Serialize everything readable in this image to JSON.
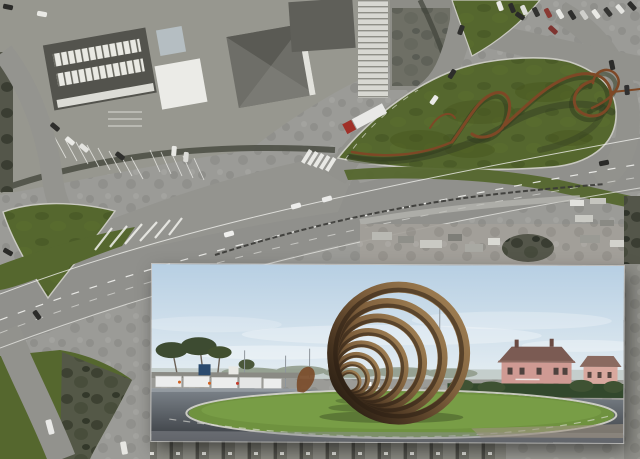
{
  "meta": {
    "width": 640,
    "height": 459,
    "kind": "aerial-photomontage-with-render-inset"
  },
  "palette": {
    "base_gray": "#9b9b97",
    "road_gray": "#90908c",
    "plaza_gray": "#94948f",
    "building_dark": "#53534d",
    "building_white": "#ebebe7",
    "grass_overlay": "#55672e",
    "grass_dark": "#46551f",
    "ribbon_rust": "#7e4826",
    "ribbon_shadow": "#2f3a1e",
    "guardrail": "#3a3a36",
    "marking_white": "#f2f2ee",
    "scrub_dark": "#45473d",
    "hedge_dark": "#4e5046",
    "inset_sky_top": "#b7cfe3",
    "inset_sky_bottom": "#e4edf2",
    "inset_lawn": "#6f923f",
    "inset_asphalt_near": "#383c41",
    "inset_asphalt_far": "#7d848b",
    "ring_light": "#a08054",
    "ring_dark": "#241a10",
    "villa_pink": "#cf9a93",
    "villa_roof": "#7b5b53",
    "pine_green": "#3d4b31",
    "hedge_green": "#32482c",
    "curb_light": "#d6d6cc"
  },
  "aerial": {
    "vehicles": [
      {
        "x": 8,
        "y": 7,
        "r": 12,
        "c": "#2b2b29"
      },
      {
        "x": 42,
        "y": 14,
        "r": 10,
        "c": "#e9e9e5"
      },
      {
        "x": 55,
        "y": 127,
        "r": 40,
        "c": "#2e2e2c"
      },
      {
        "x": 70,
        "y": 141,
        "r": 40,
        "c": "#eaeae6"
      },
      {
        "x": 84,
        "y": 148,
        "r": 40,
        "c": "#e3e3df"
      },
      {
        "x": 120,
        "y": 156,
        "r": 38,
        "c": "#2f2f2d"
      },
      {
        "x": 174,
        "y": 151,
        "r": 95,
        "c": "#e8e8e4"
      },
      {
        "x": 186,
        "y": 157,
        "r": 95,
        "c": "#dcdcd8"
      },
      {
        "x": 500,
        "y": 6,
        "r": 70,
        "c": "#eaeae6"
      },
      {
        "x": 512,
        "y": 8,
        "r": 68,
        "c": "#2c2c2a"
      },
      {
        "x": 524,
        "y": 10,
        "r": 66,
        "c": "#ddddd9"
      },
      {
        "x": 536,
        "y": 12,
        "r": 64,
        "c": "#323230"
      },
      {
        "x": 548,
        "y": 13,
        "r": 62,
        "c": "#8a3a34"
      },
      {
        "x": 560,
        "y": 14,
        "r": 60,
        "c": "#e7e7e3"
      },
      {
        "x": 572,
        "y": 15,
        "r": 58,
        "c": "#2e2e2c"
      },
      {
        "x": 584,
        "y": 15,
        "r": 56,
        "c": "#cfcfcb"
      },
      {
        "x": 596,
        "y": 14,
        "r": 54,
        "c": "#e9e9e5"
      },
      {
        "x": 608,
        "y": 12,
        "r": 52,
        "c": "#343432"
      },
      {
        "x": 620,
        "y": 9,
        "r": 50,
        "c": "#e5e5e1"
      },
      {
        "x": 632,
        "y": 6,
        "r": 48,
        "c": "#2d2d2b"
      },
      {
        "x": 520,
        "y": 16,
        "r": 35,
        "c": "#2a2a28"
      },
      {
        "x": 553,
        "y": 30,
        "r": 42,
        "c": "#7e3430"
      },
      {
        "x": 612,
        "y": 65,
        "r": 78,
        "c": "#2c2c2a"
      },
      {
        "x": 627,
        "y": 90,
        "r": 85,
        "c": "#303030"
      },
      {
        "x": 604,
        "y": 163,
        "r": -12,
        "c": "#2a2a28"
      },
      {
        "x": 434,
        "y": 100,
        "r": -55,
        "c": "#eaeae8"
      },
      {
        "x": 452,
        "y": 74,
        "r": -58,
        "c": "#2d2d2b"
      },
      {
        "x": 461,
        "y": 30,
        "r": -70,
        "c": "#2f2f2d"
      },
      {
        "x": 296,
        "y": 206,
        "r": -15,
        "c": "#ededeb"
      },
      {
        "x": 327,
        "y": 199,
        "r": -15,
        "c": "#eaeae8"
      },
      {
        "x": 229,
        "y": 234,
        "r": -15,
        "c": "#efefed"
      },
      {
        "x": 37,
        "y": 315,
        "r": 55,
        "c": "#2c2c2a"
      },
      {
        "x": 8,
        "y": 252,
        "r": 30,
        "c": "#2a2a28"
      },
      {
        "x": 50,
        "y": 427,
        "r": 75,
        "c": "#e9e9e7",
        "w": 15,
        "h": 6
      },
      {
        "x": 124,
        "y": 448,
        "r": 80,
        "c": "#e6e6e2",
        "w": 13,
        "h": 6
      }
    ],
    "truck": {
      "x": 366,
      "y": 118,
      "r": -28,
      "trailer": "#e9e9e7",
      "cab": "#a03028"
    }
  },
  "inset": {
    "rings": [
      {
        "cx": 247,
        "cy": 88,
        "r": 66,
        "sw": 11
      },
      {
        "cx": 236,
        "cy": 93,
        "r": 55,
        "sw": 10
      },
      {
        "cx": 226,
        "cy": 98,
        "r": 45,
        "sw": 9
      },
      {
        "cx": 217,
        "cy": 103,
        "r": 36,
        "sw": 8
      },
      {
        "cx": 210,
        "cy": 107,
        "r": 28,
        "sw": 7
      },
      {
        "cx": 205,
        "cy": 111,
        "r": 21,
        "sw": 6
      },
      {
        "cx": 201,
        "cy": 114,
        "r": 15,
        "sw": 5
      },
      {
        "cx": 198,
        "cy": 117,
        "r": 10,
        "sw": 4
      }
    ]
  }
}
